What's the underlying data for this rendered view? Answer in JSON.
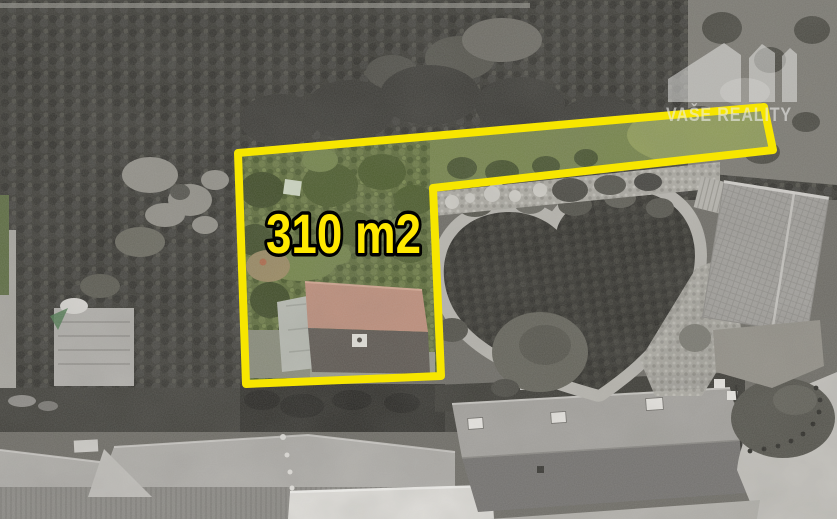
{
  "annotation": {
    "area_label": "310 m2"
  },
  "watermark": {
    "brand": "VAŠE REALITY",
    "logo": "three-roofs-icon"
  },
  "colors": {
    "boundary_yellow": "#f7e600",
    "label_fill": "#ffe800",
    "label_outline": "#000000",
    "watermark_white": "#ededeb"
  }
}
